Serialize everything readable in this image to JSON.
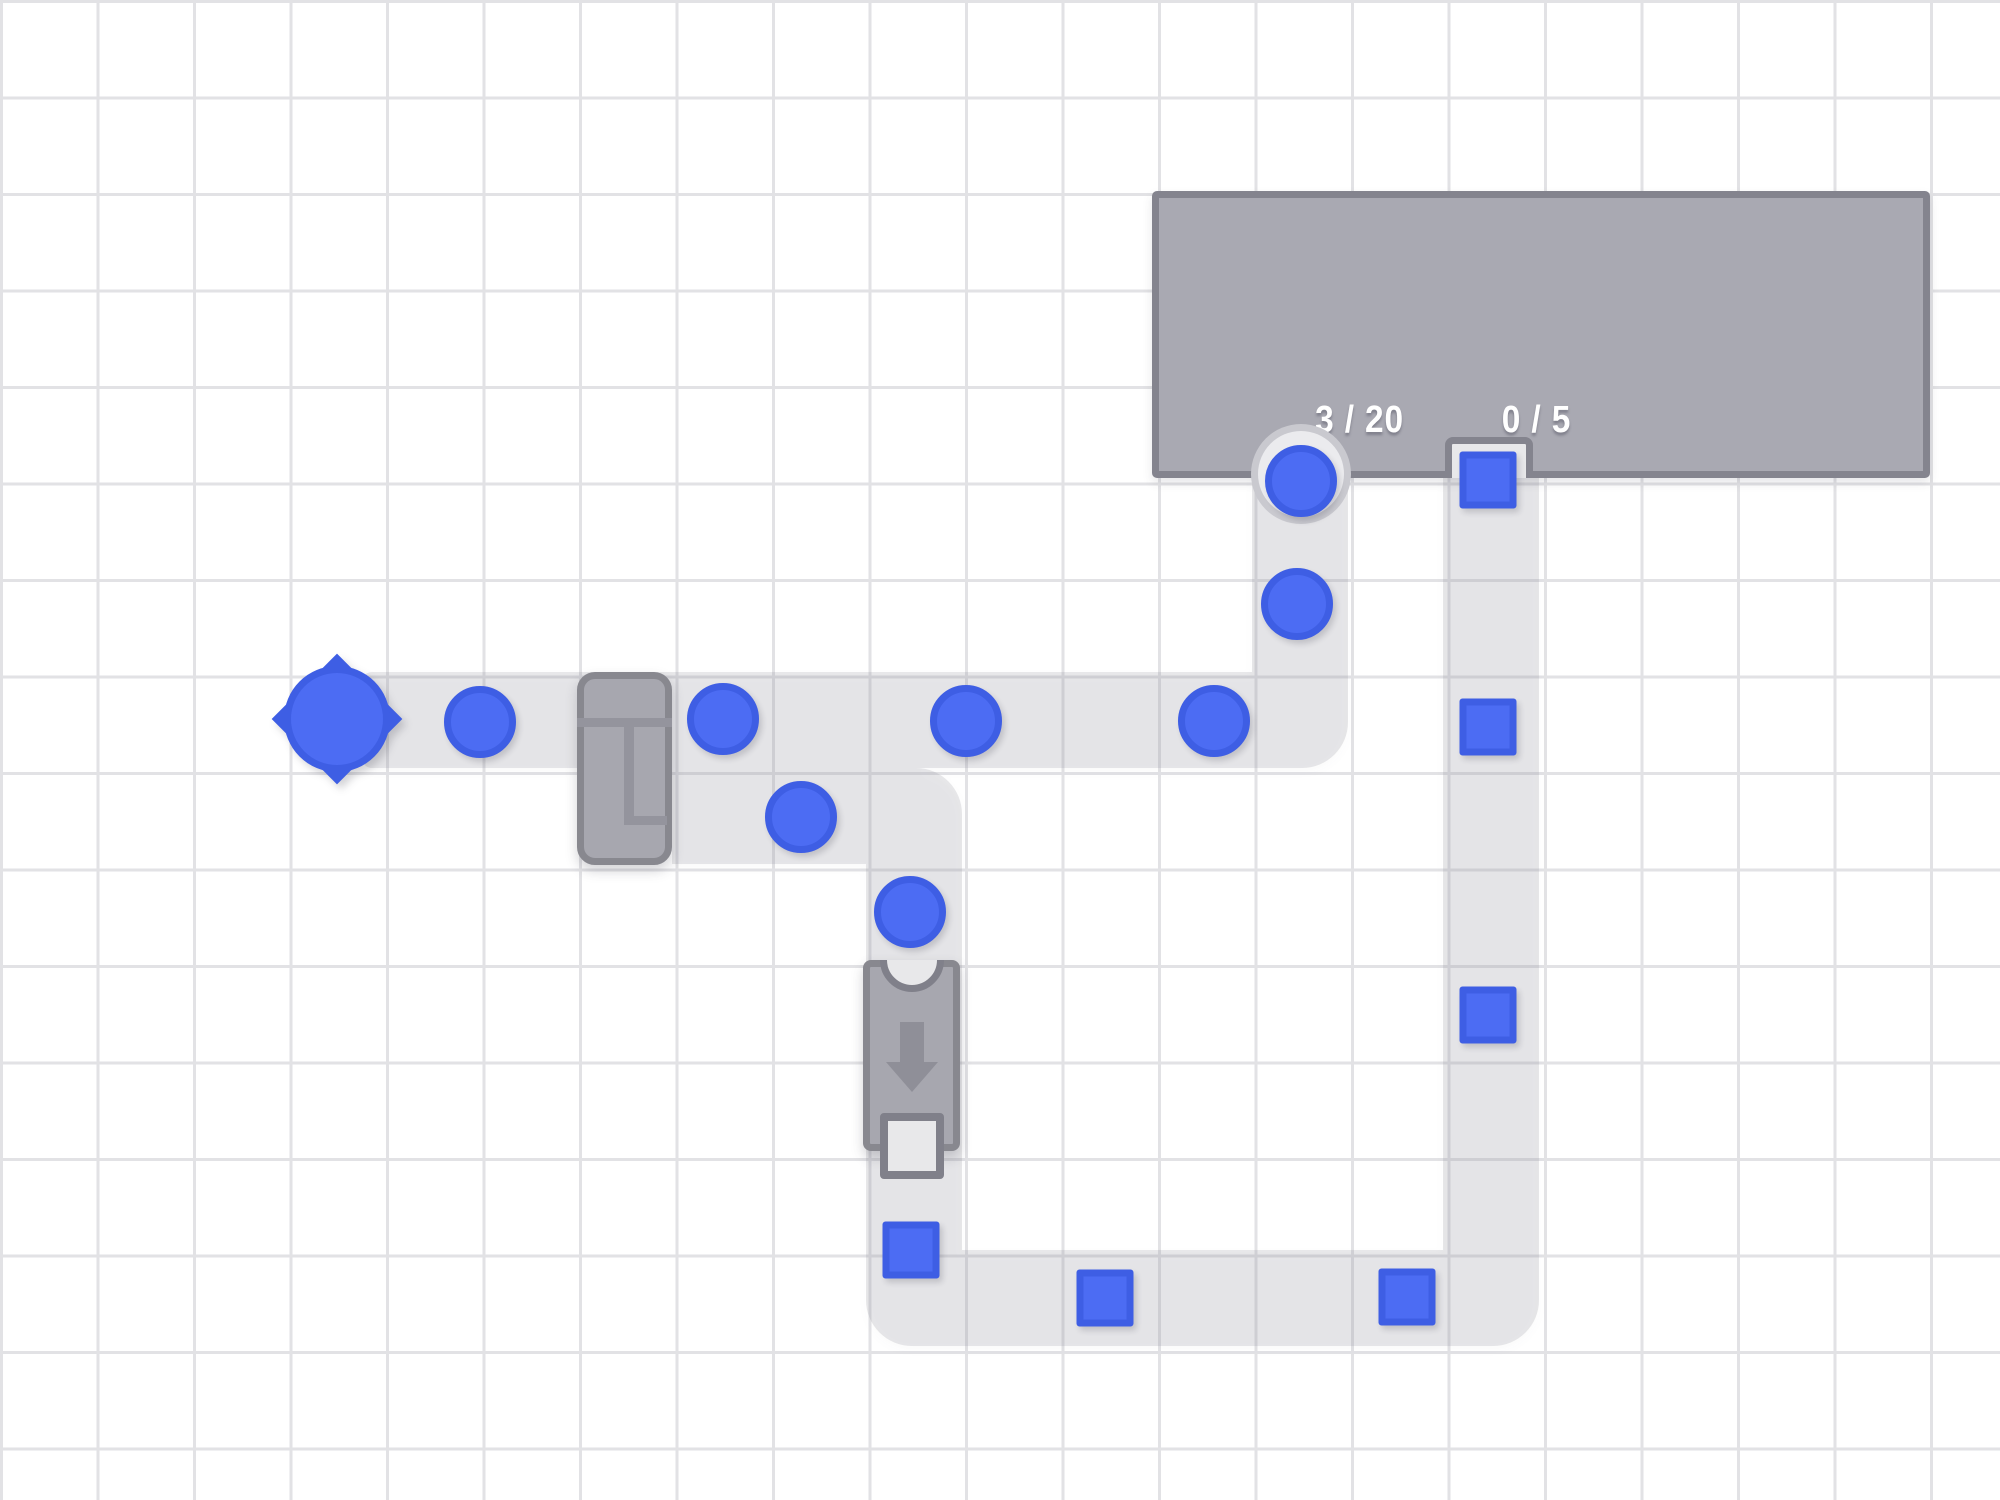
{
  "counters": {
    "circles_label": "3 / 20",
    "squares_label": "0 / 5"
  },
  "colors": {
    "bg": "#ffffff",
    "grid_line": "#e2e2e5",
    "belt": "rgba(150,150,158,0.22)",
    "hub_fill": "#a9a9b2",
    "hub_border": "#84848e",
    "machine_fill": "#a7a7af",
    "machine_border": "#88888f",
    "machine_detail": "#94949d",
    "arrow": "#8f8f98",
    "item_fill": "#4c6cf3",
    "item_ring": "#3e5ee4",
    "socket_fill": "#e8e8ea",
    "socket_rim": "#80808a",
    "notch_rim": "#c9c9cf",
    "notch_fill": "#ebebee",
    "counter_text": "#ffffff"
  },
  "grid": {
    "cell_px": 96.5,
    "line_px": 3
  },
  "hub": {
    "x": 1152,
    "y": 191,
    "w": 778,
    "h": 287,
    "counter_circles": {
      "cx": 150,
      "cy": 201
    },
    "counter_squares": {
      "cx": 338,
      "cy": 201
    },
    "circle_input": {
      "cx": 1301,
      "cy": 474
    },
    "square_input": {
      "x": 1445,
      "y": 437,
      "w": 88,
      "h": 41
    }
  },
  "belts": [
    {
      "x": 362,
      "y": 672,
      "w": 890,
      "h": 96,
      "r": "10px 0 0 10px"
    },
    {
      "x": 1252,
      "y": 672,
      "w": 96,
      "h": 96,
      "r": "0 0 46px 0"
    },
    {
      "x": 1252,
      "y": 470,
      "w": 96,
      "h": 202,
      "r": "0"
    },
    {
      "x": 672,
      "y": 768,
      "w": 194,
      "h": 96,
      "r": "0"
    },
    {
      "x": 866,
      "y": 768,
      "w": 96,
      "h": 96,
      "r": "0 46px 0 0"
    },
    {
      "x": 866,
      "y": 864,
      "w": 96,
      "h": 386,
      "r": "0"
    },
    {
      "x": 866,
      "y": 1250,
      "w": 96,
      "h": 96,
      "r": "0 0 0 46px"
    },
    {
      "x": 962,
      "y": 1250,
      "w": 481,
      "h": 96,
      "r": "0"
    },
    {
      "x": 1443,
      "y": 1250,
      "w": 96,
      "h": 96,
      "r": "0 0 46px 0"
    },
    {
      "x": 1443,
      "y": 470,
      "w": 96,
      "h": 780,
      "r": "0"
    }
  ],
  "items": {
    "circles": [
      {
        "cx": 480,
        "cy": 722
      },
      {
        "cx": 723,
        "cy": 719
      },
      {
        "cx": 966,
        "cy": 721
      },
      {
        "cx": 1214,
        "cy": 721
      },
      {
        "cx": 1297,
        "cy": 604
      },
      {
        "cx": 1301,
        "cy": 481
      },
      {
        "cx": 801,
        "cy": 817
      },
      {
        "cx": 910,
        "cy": 912
      }
    ],
    "squares": [
      {
        "cx": 911,
        "cy": 1250
      },
      {
        "cx": 1105,
        "cy": 1298
      },
      {
        "cx": 1407,
        "cy": 1297
      },
      {
        "cx": 1488,
        "cy": 1015
      },
      {
        "cx": 1488,
        "cy": 727
      },
      {
        "cx": 1488,
        "cy": 480
      }
    ]
  },
  "node": {
    "cx": 337,
    "cy": 719
  },
  "machines": {
    "extractor": {
      "x": 577,
      "y": 672,
      "w": 95,
      "h": 193
    },
    "tunnel": {
      "x": 863,
      "y": 960,
      "w": 97,
      "h": 191
    }
  }
}
